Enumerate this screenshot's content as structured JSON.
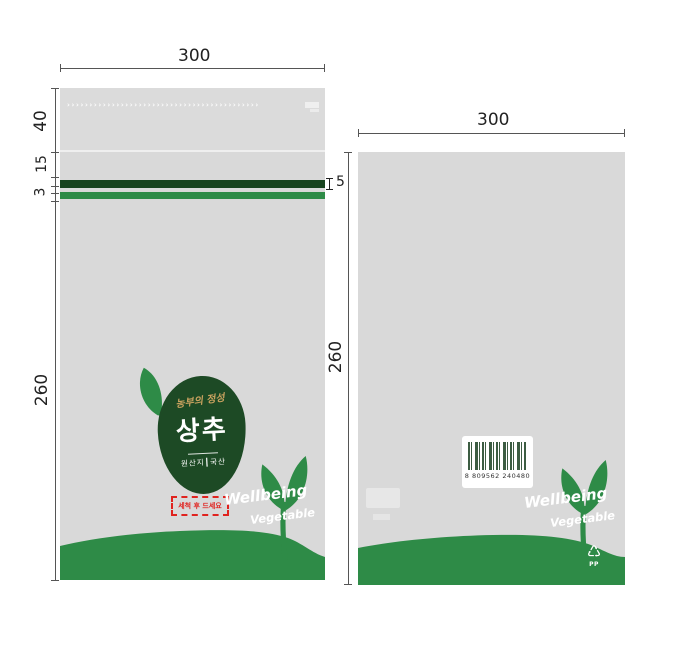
{
  "colors": {
    "bag_gray": "#d9d9d9",
    "stripe_dark_green": "#17431e",
    "stripe_green": "#2e8b47",
    "logo_green": "#1d4a25",
    "warning_red": "#e0231f",
    "script_tan": "#c9a25f",
    "dim_line": "#555555"
  },
  "front_bag": {
    "dims": {
      "width": "300",
      "flap": "40",
      "gap": "15",
      "small": "3",
      "stripe": "5",
      "body": "260"
    },
    "perforation_marks": "›››››››››››››››››››››››››››››››››››››››››››",
    "logo": {
      "script_text": "농부의 정성",
      "product_name": "상추",
      "origin_text": "원산지┃국산"
    },
    "warning_text": "세척 후 드세요",
    "wellbeing_text": "Wellbeing",
    "vegetable_text": "Vegetable"
  },
  "back_bag": {
    "dims": {
      "width": "300",
      "height": "260"
    },
    "barcode_number": "8 809562 240480",
    "wellbeing_text": "Wellbeing",
    "vegetable_text": "Vegetable",
    "recycle_symbol": "♺",
    "recycle_material": "PP"
  }
}
